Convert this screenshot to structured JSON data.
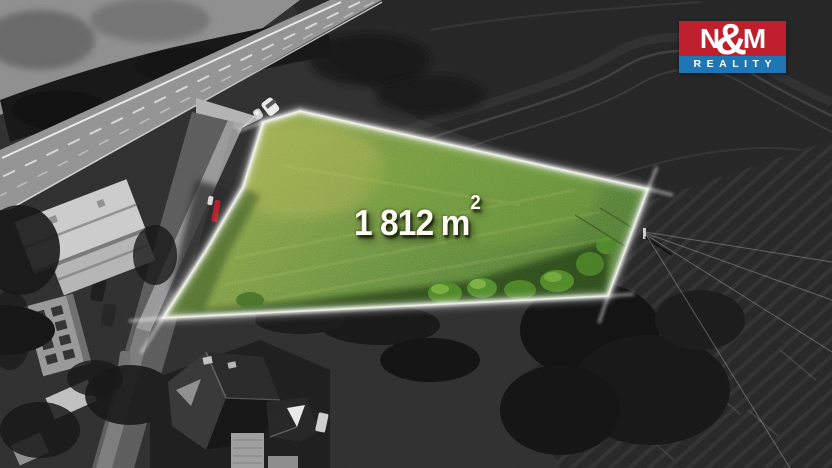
{
  "watermark": {
    "area_value": "1 812",
    "area_unit": "m",
    "area_superscript": "2",
    "text_color": "#fcfcf2"
  },
  "logo": {
    "letter_left": "N",
    "ampersand": "&",
    "letter_right": "M",
    "subtitle": "REALITY",
    "red": "#c0202e",
    "blue": "#1e76b4",
    "text_color": "#ffffff"
  },
  "plot": {
    "outline_color": "#ffffff",
    "grass_base": "#6f9631"
  }
}
